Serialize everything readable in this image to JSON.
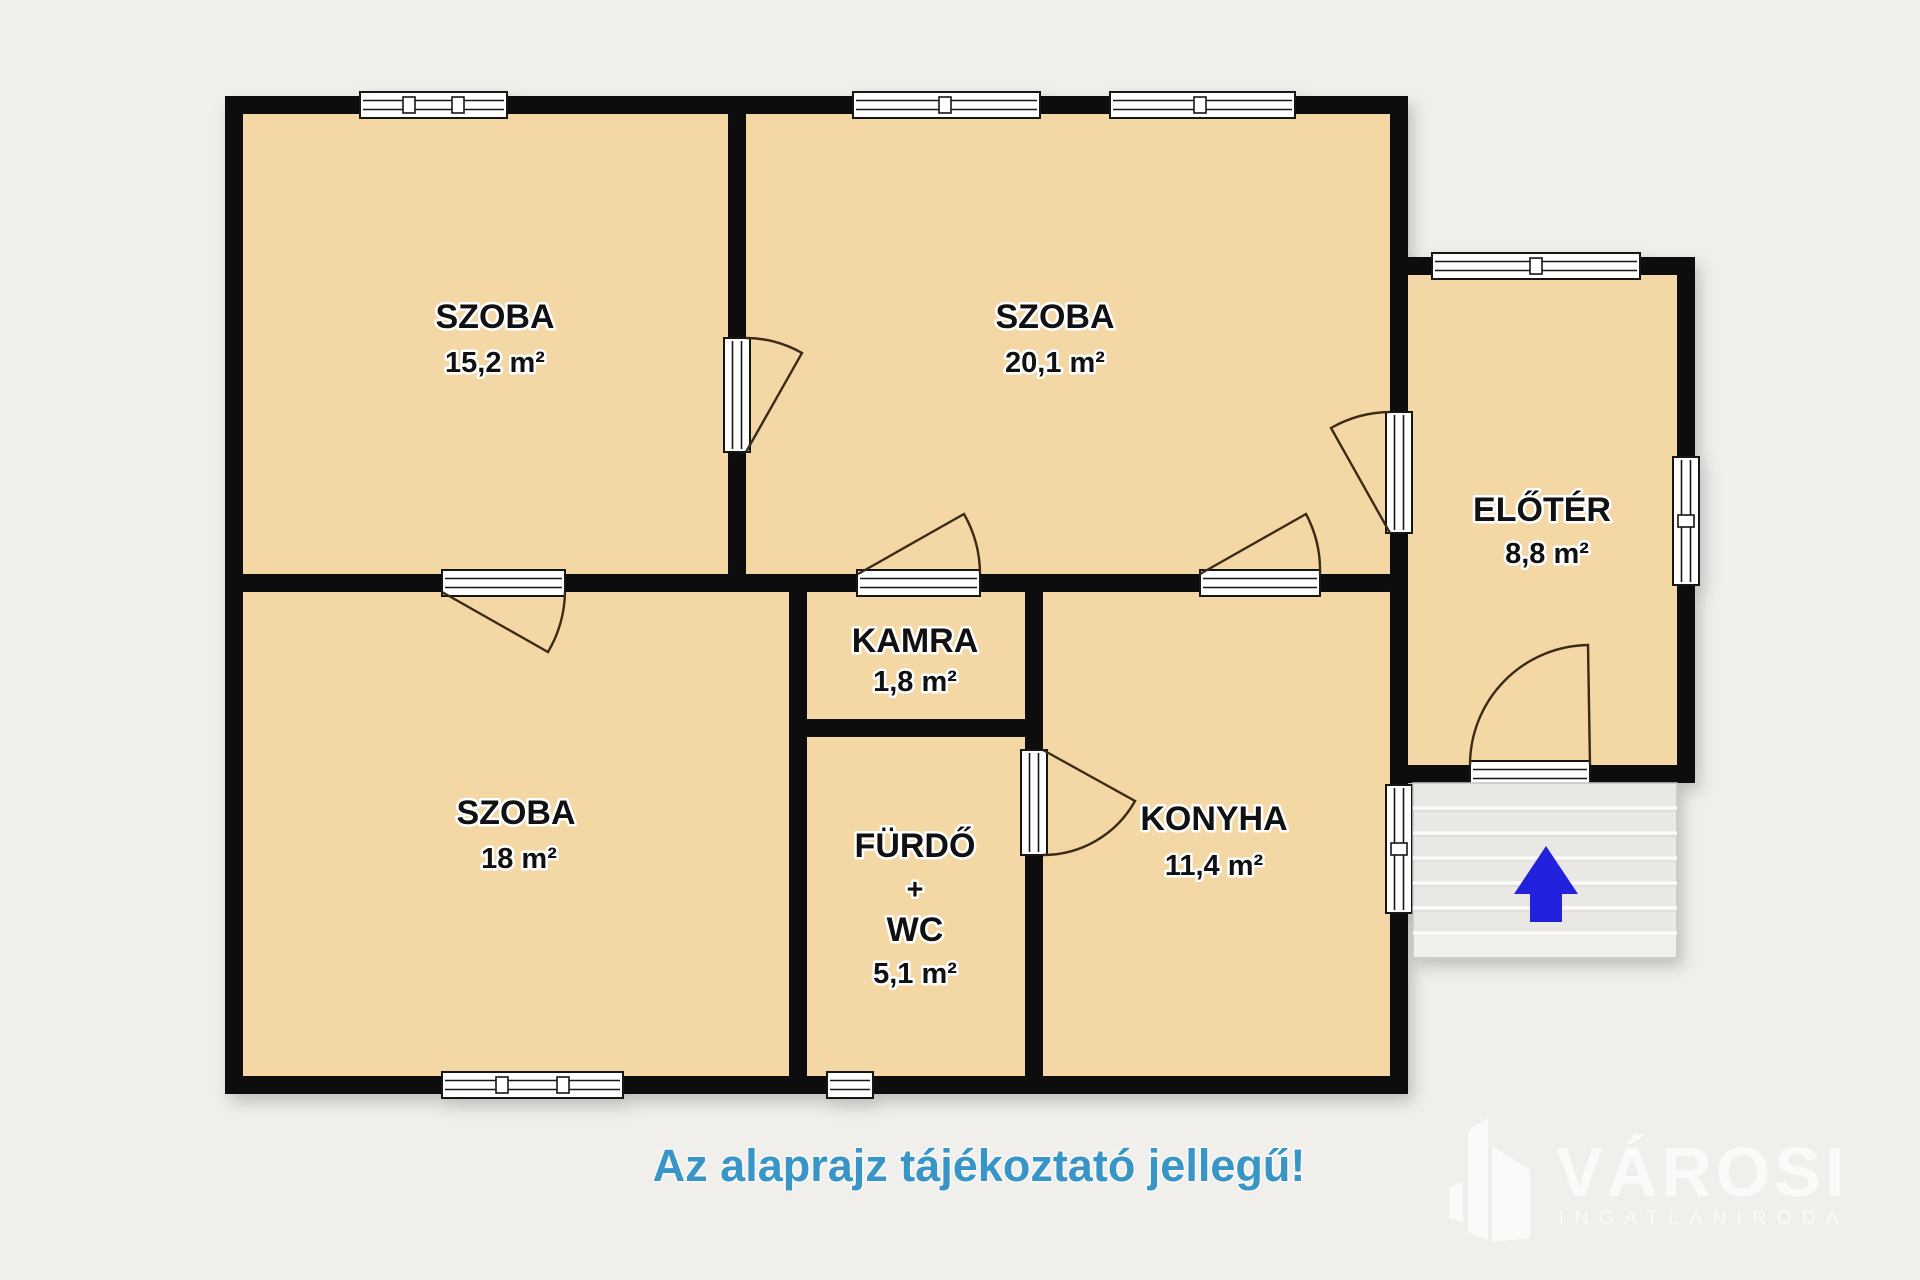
{
  "disclaimer": "Az alaprajz tájékoztató jellegű!",
  "brand": {
    "name": "VÁROSI",
    "subtitle": "INGATLANIRODA"
  },
  "rooms": [
    {
      "id": "szoba-1",
      "label": "SZOBA",
      "area": "15,2 m²"
    },
    {
      "id": "szoba-2",
      "label": "SZOBA",
      "area": "20,1 m²"
    },
    {
      "id": "eloter",
      "label": "ELŐTÉR",
      "area": "8,8 m²"
    },
    {
      "id": "szoba-3",
      "label": "SZOBA",
      "area": "18 m²"
    },
    {
      "id": "kamra",
      "label": "KAMRA",
      "area": "1,8 m²"
    },
    {
      "id": "furdo",
      "label": "FÜRDŐ",
      "plus": "+",
      "wc": "WC",
      "area": "5,1 m²"
    },
    {
      "id": "konyha",
      "label": "KONYHA",
      "area": "11,4 m²"
    }
  ],
  "stairs": {
    "direction_arrow": "up"
  },
  "colors": {
    "bg": "#f0efeb",
    "floor": "#f3d8a6",
    "wall": "#0b0b0b",
    "window": "#ffffff",
    "door_arc": "#3a2a17",
    "stairs": "#e9e8e5",
    "stairs_light": "#f0efec",
    "arrow": "#2321dc",
    "disclaimer": "#3795c7",
    "watermark": "#fbfaf8",
    "label": "#111111"
  }
}
